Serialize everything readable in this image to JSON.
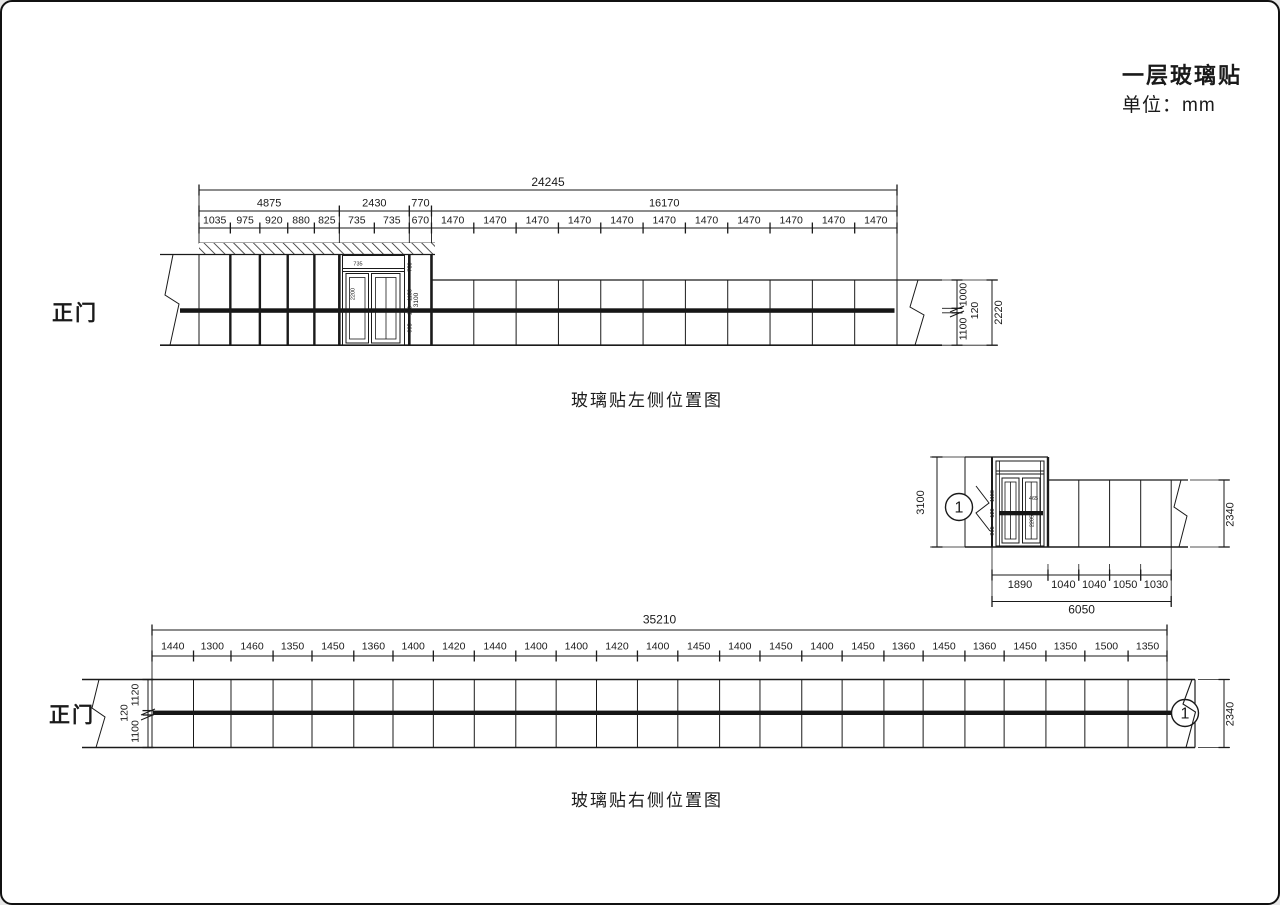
{
  "page": {
    "title": "一层玻璃贴",
    "unit": "单位：mm"
  },
  "colors": {
    "ink": "#1a1a1a",
    "band": "#161616",
    "bg": "#ffffff"
  },
  "left_view": {
    "entrance_label": "正门",
    "caption": "玻璃贴左侧位置图",
    "total": "24245",
    "groups": [
      "4875",
      "2430",
      "770",
      "16170"
    ],
    "segments": [
      "1035",
      "975",
      "920",
      "880",
      "825",
      "735",
      "735",
      "670",
      "1470",
      "1470",
      "1470",
      "1470",
      "1470",
      "1470",
      "1470",
      "1470",
      "1470",
      "1470",
      "1470"
    ],
    "right_chain": [
      "1000",
      "120",
      "1100"
    ],
    "right_total": "2220",
    "door": {
      "top_width": "735",
      "glass_height": "2200",
      "chain": [
        "750",
        "1150",
        "120",
        "995"
      ],
      "overall_height": "3100"
    }
  },
  "detail_view": {
    "marker": "1",
    "left_height": "3100",
    "right_height": "2340",
    "segments": [
      "1890",
      "1040",
      "1040",
      "1050",
      "1030"
    ],
    "total": "6050",
    "door": {
      "pane_width": "465",
      "glass_height": "2205",
      "chain": [
        "1150",
        "120",
        "995"
      ]
    }
  },
  "right_view": {
    "entrance_label": "正门",
    "caption": "玻璃贴右侧位置图",
    "marker": "1",
    "total": "35210",
    "segments": [
      "1440",
      "1300",
      "1460",
      "1350",
      "1450",
      "1360",
      "1400",
      "1420",
      "1440",
      "1400",
      "1400",
      "1420",
      "1400",
      "1450",
      "1400",
      "1450",
      "1400",
      "1450",
      "1360",
      "1450",
      "1360",
      "1450",
      "1350",
      "1500",
      "1350"
    ],
    "left_chain": [
      "1120",
      "120",
      "1100"
    ],
    "right_height": "2340"
  }
}
